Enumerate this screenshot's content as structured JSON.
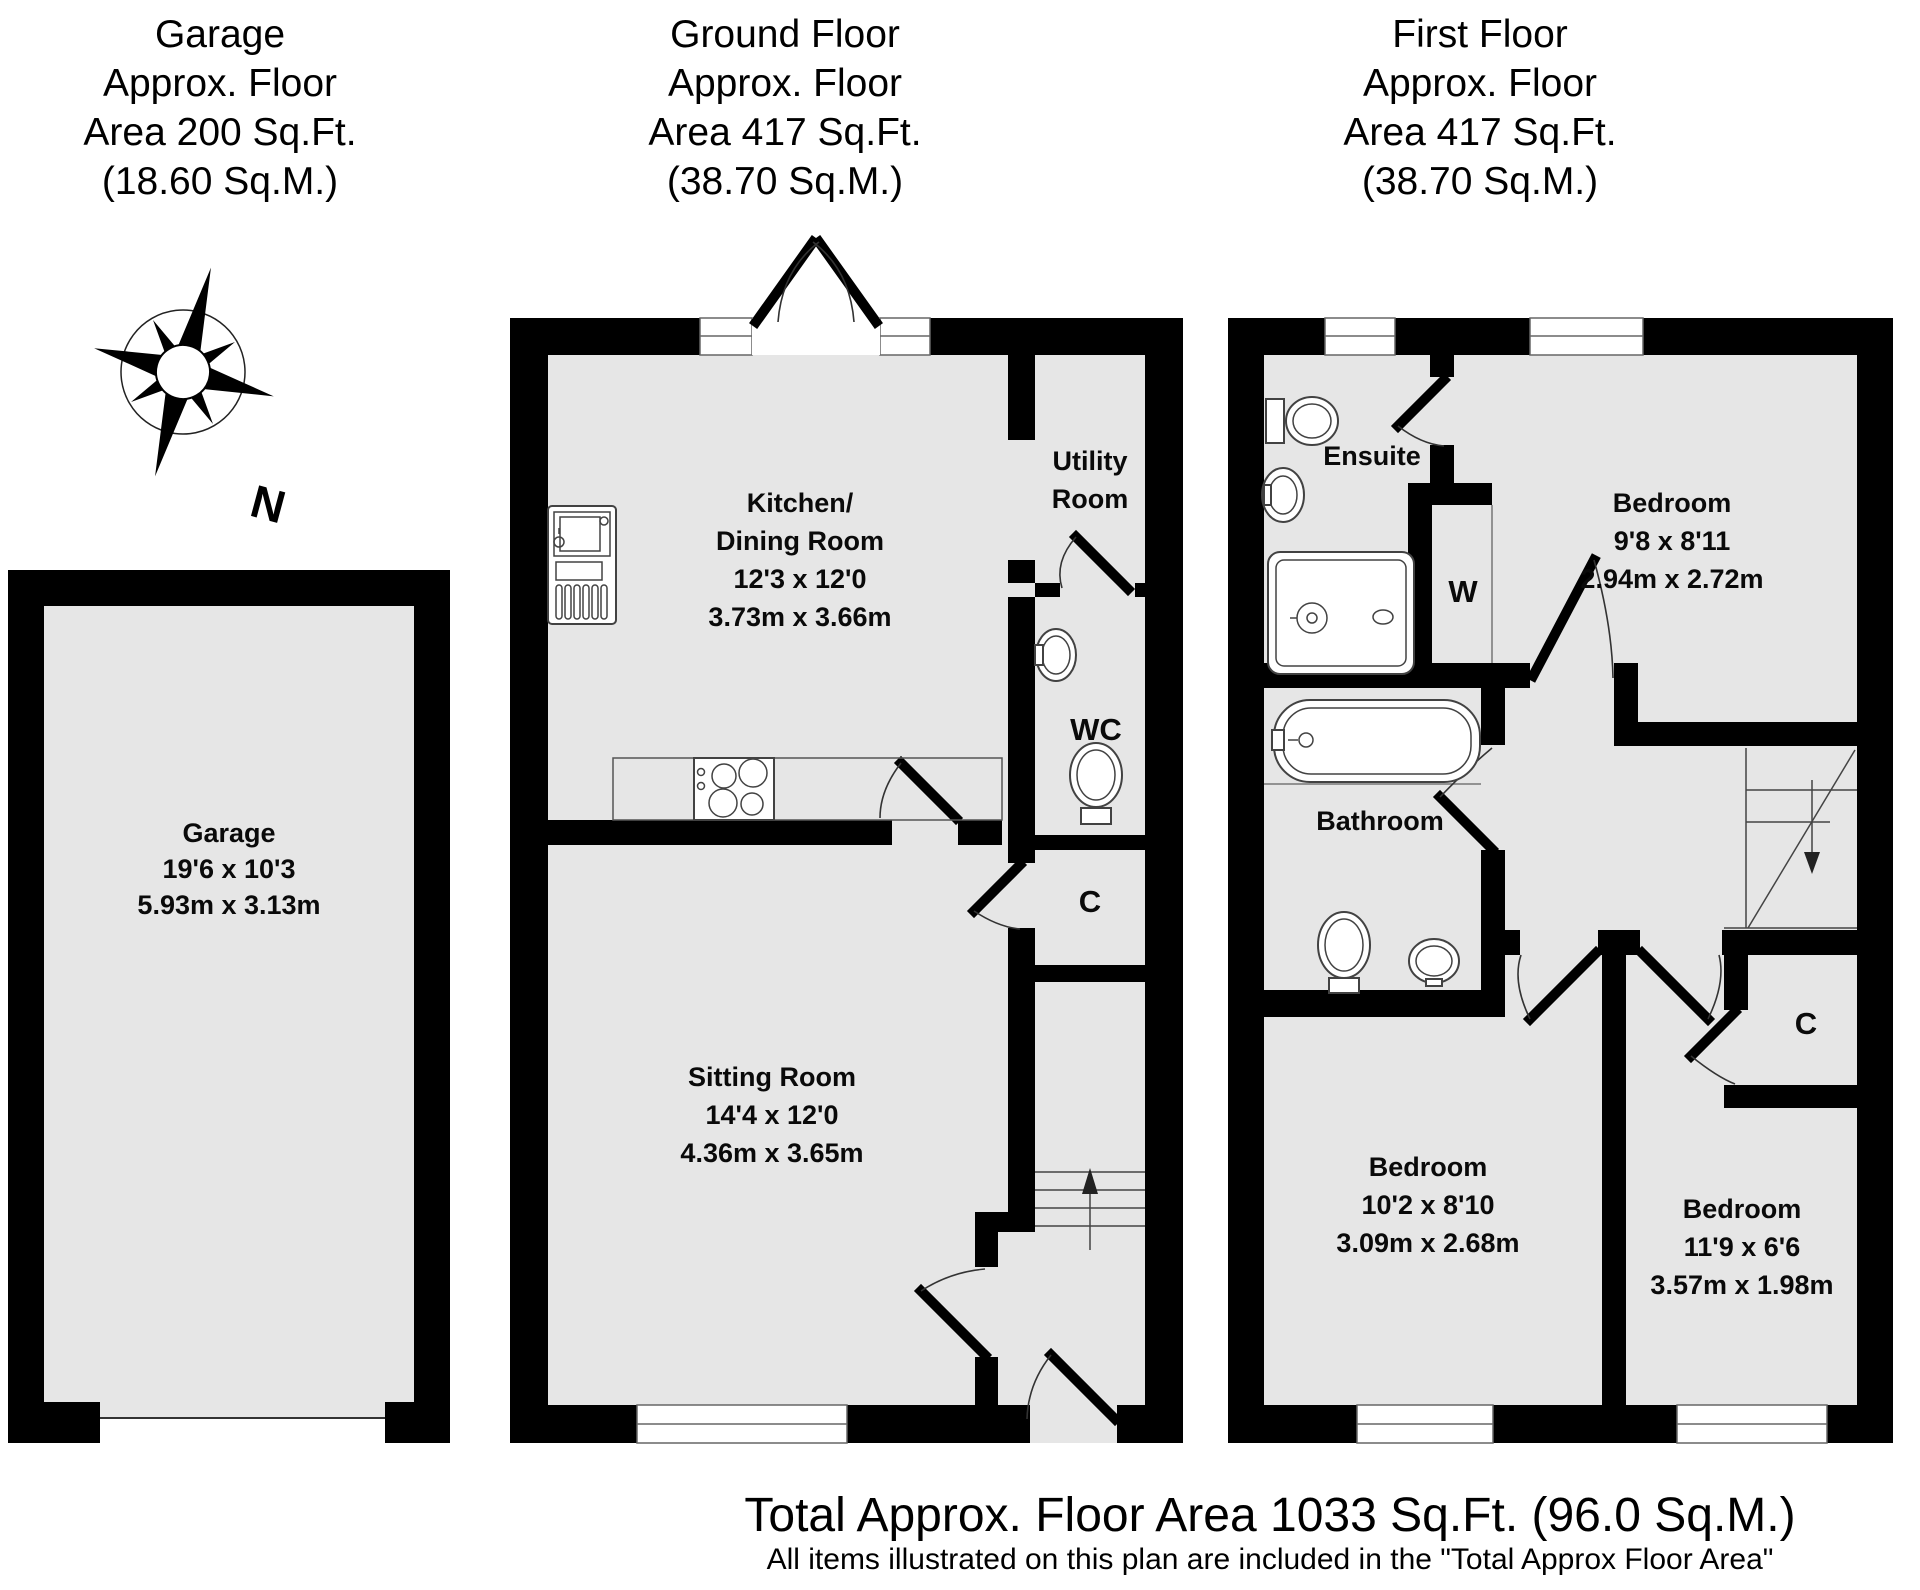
{
  "headers": {
    "garage": {
      "lines": [
        "Garage",
        "Approx. Floor",
        "Area 200 Sq.Ft.",
        "(18.60 Sq.M.)"
      ]
    },
    "ground_floor": {
      "lines": [
        "Ground Floor",
        "Approx. Floor",
        "Area 417 Sq.Ft.",
        "(38.70 Sq.M.)"
      ]
    },
    "first_floor": {
      "lines": [
        "First Floor",
        "Approx. Floor",
        "Area 417 Sq.Ft.",
        "(38.70 Sq.M.)"
      ]
    }
  },
  "compass": {
    "north_label": "N"
  },
  "rooms": {
    "garage": {
      "name": "Garage",
      "dims_imperial": "19'6 x 10'3",
      "dims_metric": "5.93m x 3.13m"
    },
    "kitchen_dining": {
      "name_line1": "Kitchen/",
      "name_line2": "Dining Room",
      "dims_imperial": "12'3 x 12'0",
      "dims_metric": "3.73m x 3.66m"
    },
    "utility": {
      "name_line1": "Utility",
      "name_line2": "Room"
    },
    "wc": {
      "name": "WC"
    },
    "cupboard_ground": {
      "name": "C"
    },
    "sitting_room": {
      "name": "Sitting Room",
      "dims_imperial": "14'4 x 12'0",
      "dims_metric": "4.36m x 3.65m"
    },
    "ensuite": {
      "name": "Ensuite"
    },
    "wardrobe": {
      "name": "W"
    },
    "bedroom_master": {
      "name": "Bedroom",
      "dims_imperial": "9'8 x 8'11",
      "dims_metric": "2.94m x 2.72m"
    },
    "bathroom": {
      "name": "Bathroom"
    },
    "bedroom_second": {
      "name": "Bedroom",
      "dims_imperial": "10'2 x 8'10",
      "dims_metric": "3.09m x 2.68m"
    },
    "bedroom_third": {
      "name": "Bedroom",
      "dims_imperial": "11'9 x 6'6",
      "dims_metric": "3.57m x 1.98m"
    },
    "cupboard_first": {
      "name": "C"
    }
  },
  "footer": {
    "total_area": "Total Approx. Floor Area 1033 Sq.Ft. (96.0 Sq.M.)",
    "disclaimer": "All items illustrated on this plan are included in the \"Total Approx Floor Area\""
  },
  "colors": {
    "wall": "#000000",
    "floor": "#e6e6e6",
    "fixture_outline": "#424242"
  }
}
